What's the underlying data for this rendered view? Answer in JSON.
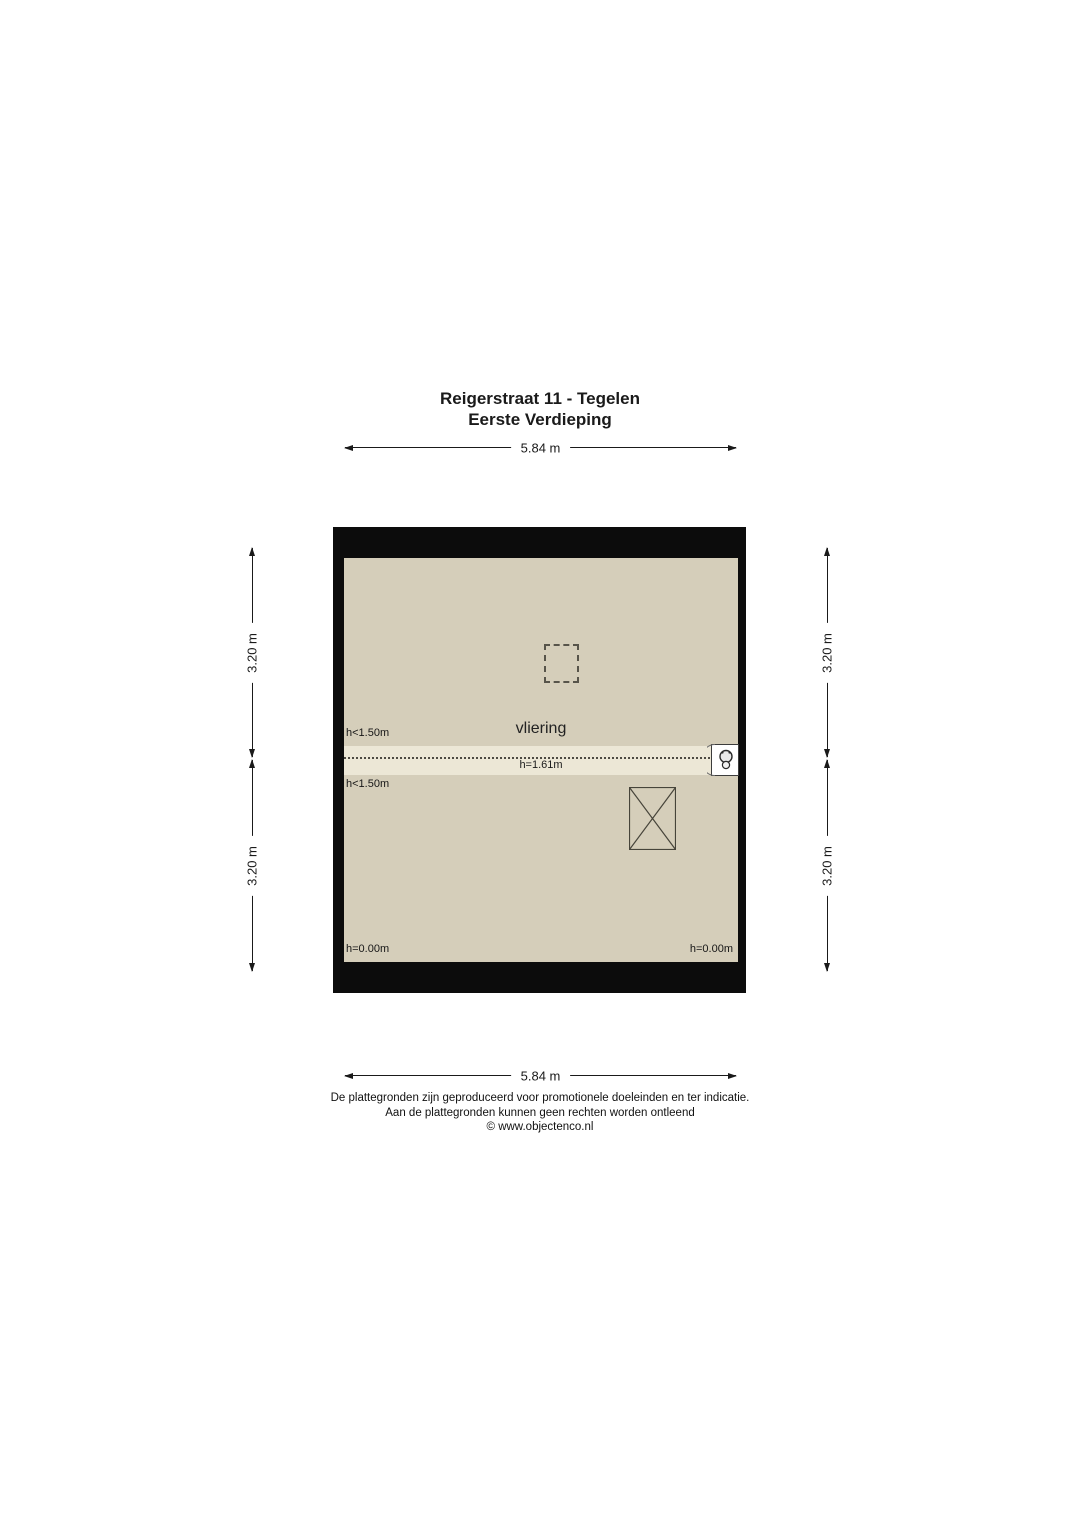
{
  "title": {
    "line1": "Reigerstraat 11 - Tegelen",
    "line2": "Eerste Verdieping"
  },
  "dimensions": {
    "top": "5.84 m",
    "bottom": "5.84 m",
    "left_upper": "3.20 m",
    "left_lower": "3.20 m",
    "right_upper": "3.20 m",
    "right_lower": "3.20 m"
  },
  "plan": {
    "room_label": "vliering",
    "height_labels": {
      "above_band_left": "h<1.50m",
      "band_center": "h=1.61m",
      "below_band_left": "h<1.50m",
      "bottom_left": "h=0.00m",
      "bottom_right": "h=0.00m"
    },
    "icons": {
      "stair_opening": "rectangle-with-x-cross",
      "roof_hatch": "dashed-square-outline",
      "ventilation_unit": "white-box-with-round-unit-glyph"
    }
  },
  "footer": {
    "line1": "De plattegronden zijn geproduceerd voor promotionele doeleinden en ter indicatie.",
    "line2": "Aan de plattegronden kunnen geen rechten worden ontleend",
    "line3": "© www.objectenco.nl"
  },
  "colors": {
    "wall": "#0c0c0c",
    "floor": "#d5ceba",
    "band": "#ece7d6",
    "line": "#1a1a1a",
    "text": "#1a1a1a",
    "bg": "#ffffff"
  }
}
